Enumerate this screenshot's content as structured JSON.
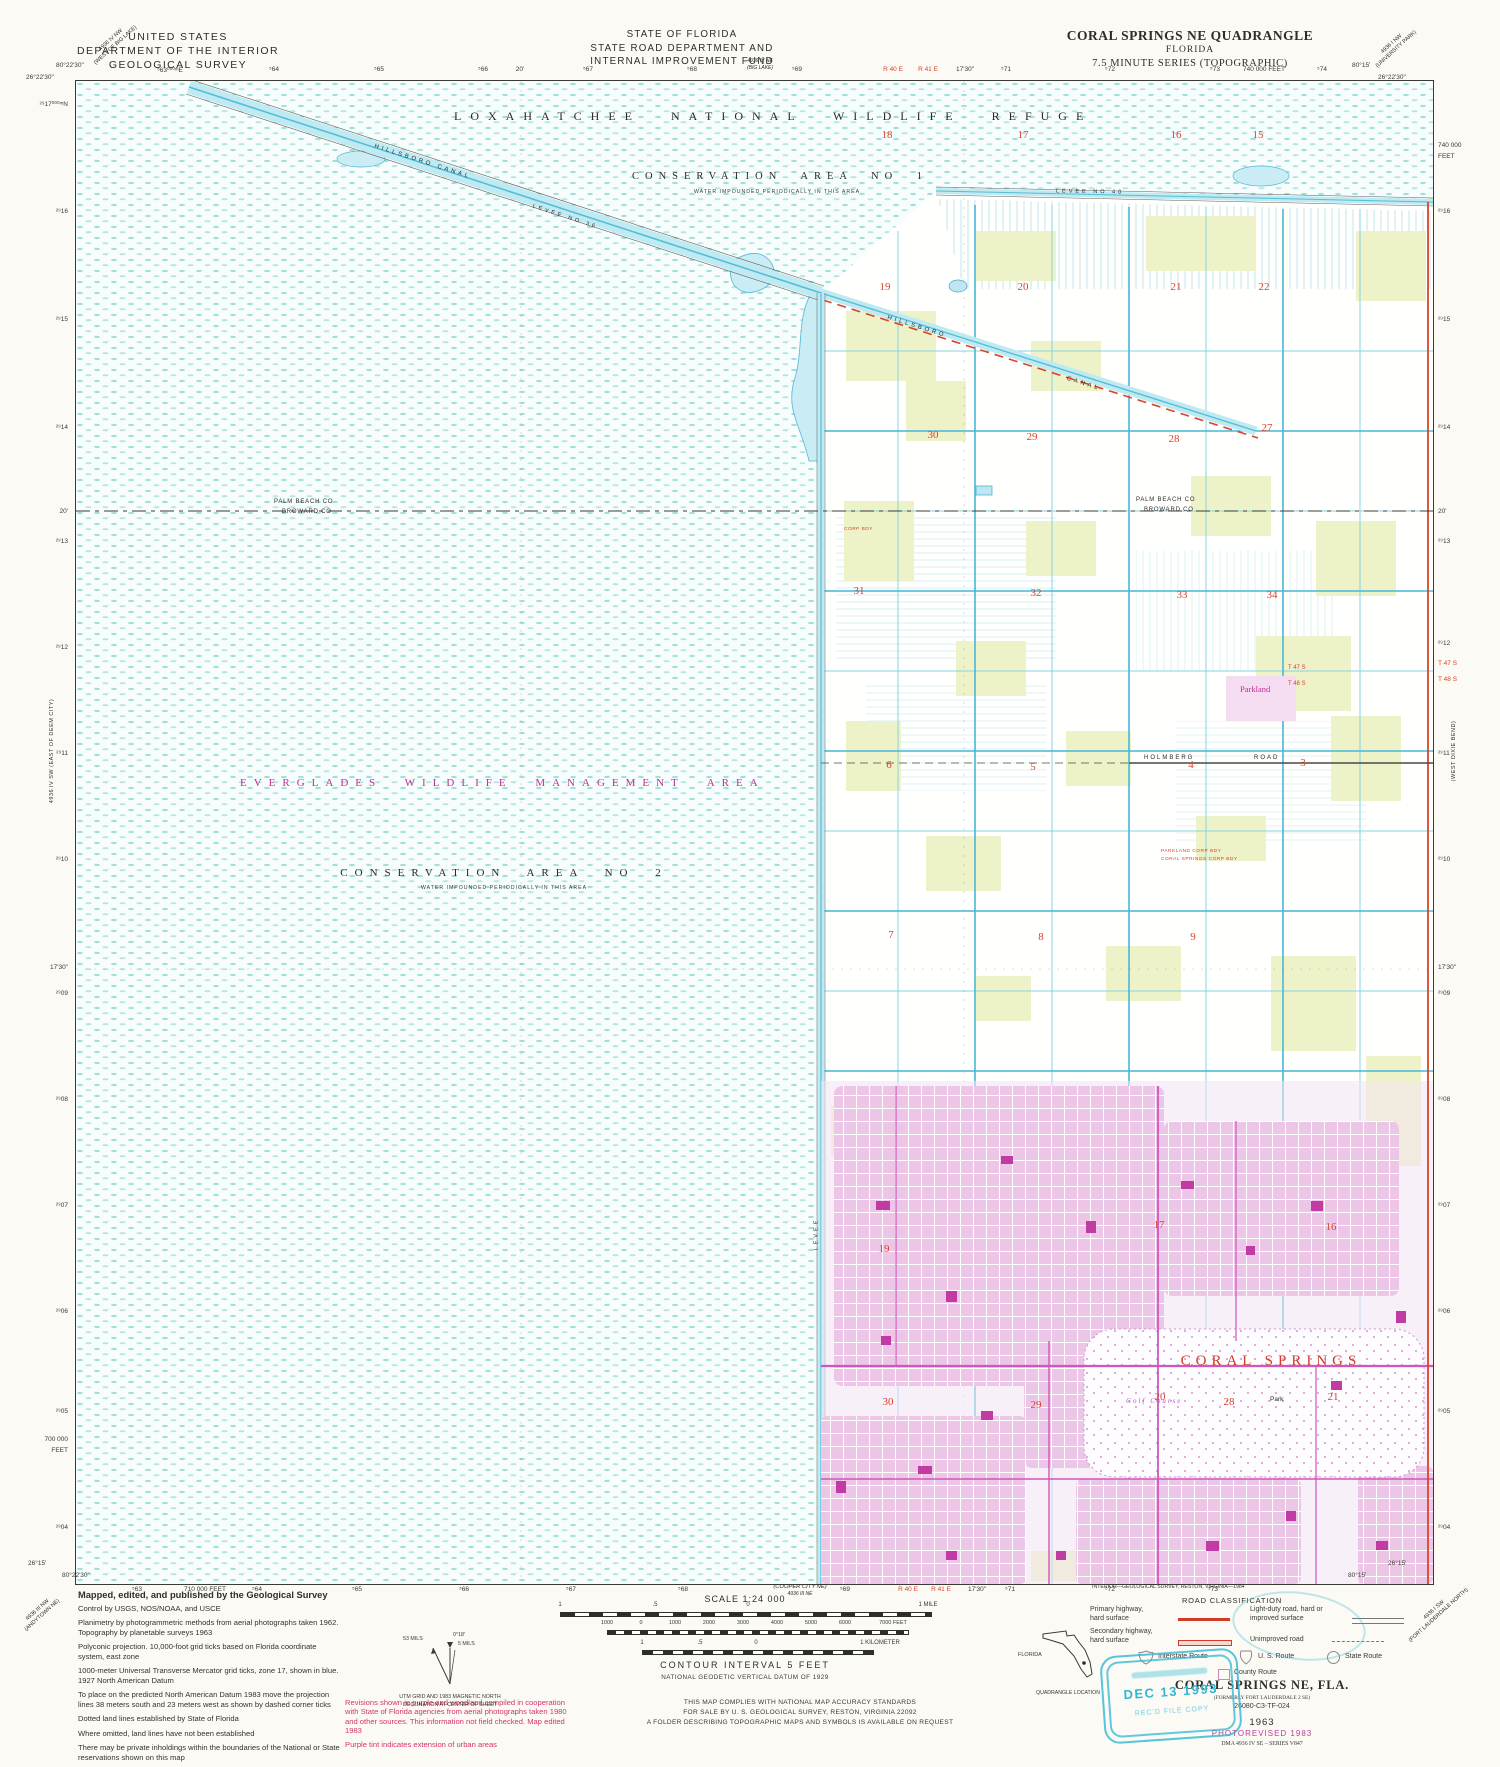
{
  "colors": {
    "map_red": "#d8432c",
    "magenta": "#c23a9b",
    "print_red": "#d5336e",
    "canal_cyan": "#54bdd8",
    "stamp_cyan": "#2fb7d4"
  },
  "header": {
    "agency_line1": "UNITED STATES",
    "agency_line2": "DEPARTMENT OF THE INTERIOR",
    "agency_line3": "GEOLOGICAL SURVEY",
    "state_line1": "STATE OF FLORIDA",
    "state_line2": "STATE ROAD DEPARTMENT AND",
    "state_line3": "INTERNAL IMPROVEMENT FUND",
    "state_sub1": "4936 IV NE",
    "state_sub2": "(BIG LAKE)",
    "quad_line1": "CORAL SPRINGS NE QUADRANGLE",
    "quad_line2": "FLORIDA",
    "quad_line3": "7.5 MINUTE SERIES (TOPOGRAPHIC)",
    "corner_tl1": "4936 IV NW",
    "corner_tl2": "(WEST OF BIG LAKE)",
    "corner_tr1": "4936 I NW",
    "corner_tr2": "(UNIVERSITY PARK)"
  },
  "edges": {
    "top_left_lon": "80°22'30\"",
    "top_left_lat": "26°22'30\"",
    "top_right_lon": "80°15'",
    "top_right_lat": "26°22'30\"",
    "bottom_left_lat": "26°15'",
    "bottom_left_lon": "80°22'30\"",
    "bottom_right_lon": "80°15'",
    "bottom_right_lat": "26°15'",
    "side_left": "4936 IV SW (EAST OF DEEM CITY)",
    "side_right": "(WEST DIXIE BEND)",
    "corner_bl1": "4936 III NW",
    "corner_bl2": "(ANDYTOWN NE)",
    "corner_br1": "4936 I SW",
    "corner_br2": "(FORT LAUDERDALE NORTH)",
    "cooper1": "(COOPER CITY NE)",
    "cooper2": "4936 III NE",
    "top_ticks": [
      {
        "t": "⁵63⁰⁰⁰ᵐE",
        "x": 170
      },
      {
        "t": "⁵64",
        "x": 274
      },
      {
        "t": "⁵65",
        "x": 379
      },
      {
        "t": "⁵66",
        "x": 483
      },
      {
        "t": "20'",
        "x": 520
      },
      {
        "t": "⁵67",
        "x": 588
      },
      {
        "t": "⁵68",
        "x": 692
      },
      {
        "t": "⁵69",
        "x": 797
      },
      {
        "t": "R 40 E",
        "x": 893,
        "red": true
      },
      {
        "t": "R 41 E",
        "x": 928,
        "red": true
      },
      {
        "t": "17'30\"",
        "x": 965
      },
      {
        "t": "⁵71",
        "x": 1006
      },
      {
        "t": "⁵72",
        "x": 1110
      },
      {
        "t": "⁵73",
        "x": 1215
      },
      {
        "t": "740 000 FEET",
        "x": 1264
      },
      {
        "t": "⁵74",
        "x": 1322
      }
    ],
    "left_ticks": [
      {
        "t": "²⁹17⁰⁰⁰ᵐN",
        "y": 104
      },
      {
        "t": "²⁹16",
        "y": 212
      },
      {
        "t": "²⁹15",
        "y": 320
      },
      {
        "t": "²⁹14",
        "y": 428
      },
      {
        "t": "20'",
        "y": 512
      },
      {
        "t": "²⁹13",
        "y": 542
      },
      {
        "t": "²⁹12",
        "y": 648
      },
      {
        "t": "²⁹11",
        "y": 754
      },
      {
        "t": "²⁹10",
        "y": 860
      },
      {
        "t": "17'30\"",
        "y": 968
      },
      {
        "t": "²⁹09",
        "y": 994
      },
      {
        "t": "²⁹08",
        "y": 1100
      },
      {
        "t": "²⁹07",
        "y": 1206
      },
      {
        "t": "²⁹06",
        "y": 1312
      },
      {
        "t": "²⁹05",
        "y": 1412
      },
      {
        "t": "700 000",
        "y": 1440
      },
      {
        "t": "FEET",
        "y": 1451
      },
      {
        "t": "²⁹04",
        "y": 1528
      }
    ],
    "right_ticks": [
      {
        "t": "740 000",
        "y": 146
      },
      {
        "t": "FEET",
        "y": 157
      },
      {
        "t": "²⁹16",
        "y": 212
      },
      {
        "t": "²⁹15",
        "y": 320
      },
      {
        "t": "²⁹14",
        "y": 428
      },
      {
        "t": "20'",
        "y": 512
      },
      {
        "t": "²⁹13",
        "y": 542
      },
      {
        "t": "²⁹12",
        "y": 644
      },
      {
        "t": "T 47 S",
        "y": 664,
        "red": true
      },
      {
        "t": "T 48 S",
        "y": 680,
        "red": true
      },
      {
        "t": "²⁹11",
        "y": 754
      },
      {
        "t": "²⁹10",
        "y": 860
      },
      {
        "t": "17'30\"",
        "y": 968
      },
      {
        "t": "²⁹09",
        "y": 994
      },
      {
        "t": "²⁹08",
        "y": 1100
      },
      {
        "t": "²⁹07",
        "y": 1206
      },
      {
        "t": "²⁹06",
        "y": 1312
      },
      {
        "t": "²⁹05",
        "y": 1412
      },
      {
        "t": "²⁹04",
        "y": 1528
      }
    ],
    "bottom_ticks": [
      {
        "t": "⁵63",
        "x": 137
      },
      {
        "t": "710 000 FEET",
        "x": 205
      },
      {
        "t": "⁵64",
        "x": 257
      },
      {
        "t": "⁵65",
        "x": 357
      },
      {
        "t": "⁵66",
        "x": 464
      },
      {
        "t": "⁵67",
        "x": 571
      },
      {
        "t": "⁵68",
        "x": 683
      },
      {
        "t": "⁵69",
        "x": 845
      },
      {
        "t": "R 40 E",
        "x": 908,
        "red": true
      },
      {
        "t": "R 41 E",
        "x": 941,
        "red": true
      },
      {
        "t": "17'30\"",
        "x": 977
      },
      {
        "t": "⁵71",
        "x": 1010
      },
      {
        "t": "⁵72",
        "x": 1110
      },
      {
        "t": "⁵73",
        "x": 1213
      }
    ]
  },
  "map_labels": {
    "refuge": "LOXAHATCHEE NATIONAL WILDLIFE REFUGE",
    "conservation1": "CONSERVATION AREA NO 1",
    "conservation1_sub": "WATER IMPOUNDED PERIODICALLY IN THIS AREA",
    "everglades": "EVERGLADES WILDLIFE MANAGEMENT AREA",
    "conservation2": "CONSERVATION AREA NO 2",
    "conservation2_sub": "WATER IMPOUNDED PERIODICALLY IN THIS AREA",
    "hillsboro1": "HILLSBORO CANAL",
    "levee36": "LEVEE NO 36",
    "levee40": "LEVEE NO 40",
    "levee_w": "LEVEE",
    "hillsboro2": "HILLSBORO",
    "canal2": "CANAL",
    "county_n1": "PALM BEACH CO",
    "county_n2": "BROWARD CO",
    "t47": "T 47 S",
    "t48": "T 48 S",
    "parkland": "Parkland",
    "holmberg": "HOLMBERG",
    "road": "ROAD",
    "coral_springs": "CORAL SPRINGS",
    "golf": "Golf Course",
    "park": "Park",
    "corp1": "PARKLAND CORP BDY",
    "corp2": "CORAL SPRINGS CORP BDY",
    "corp3": "CORP BDY"
  },
  "section_numbers": [
    {
      "n": "18",
      "x": 811,
      "y": 48
    },
    {
      "n": "17",
      "x": 947,
      "y": 48
    },
    {
      "n": "16",
      "x": 1100,
      "y": 48
    },
    {
      "n": "15",
      "x": 1182,
      "y": 48
    },
    {
      "n": "19",
      "x": 809,
      "y": 200
    },
    {
      "n": "20",
      "x": 947,
      "y": 200
    },
    {
      "n": "21",
      "x": 1100,
      "y": 200
    },
    {
      "n": "22",
      "x": 1188,
      "y": 200
    },
    {
      "n": "30",
      "x": 857,
      "y": 348
    },
    {
      "n": "29",
      "x": 956,
      "y": 350
    },
    {
      "n": "28",
      "x": 1098,
      "y": 352
    },
    {
      "n": "27",
      "x": 1191,
      "y": 341
    },
    {
      "n": "31",
      "x": 783,
      "y": 504
    },
    {
      "n": "32",
      "x": 960,
      "y": 506
    },
    {
      "n": "33",
      "x": 1106,
      "y": 508
    },
    {
      "n": "34",
      "x": 1196,
      "y": 508
    },
    {
      "n": "6",
      "x": 813,
      "y": 678
    },
    {
      "n": "5",
      "x": 957,
      "y": 680
    },
    {
      "n": "4",
      "x": 1115,
      "y": 678
    },
    {
      "n": "3",
      "x": 1227,
      "y": 676
    },
    {
      "n": "7",
      "x": 815,
      "y": 848
    },
    {
      "n": "8",
      "x": 965,
      "y": 850
    },
    {
      "n": "9",
      "x": 1117,
      "y": 850
    },
    {
      "n": "17",
      "x": 1083,
      "y": 1138
    },
    {
      "n": "16",
      "x": 1255,
      "y": 1140
    },
    {
      "n": "19",
      "x": 808,
      "y": 1162
    },
    {
      "n": "20",
      "x": 1084,
      "y": 1310
    },
    {
      "n": "21",
      "x": 1257,
      "y": 1310
    },
    {
      "n": "30",
      "x": 812,
      "y": 1315
    },
    {
      "n": "29",
      "x": 960,
      "y": 1318
    },
    {
      "n": "28",
      "x": 1153,
      "y": 1315
    }
  ],
  "footer": {
    "credit_head": "Mapped, edited, and published by the Geological Survey",
    "credits": [
      "Control by USGS, NOS/NOAA, and USCE",
      "Planimetry by photogrammetric methods from aerial photographs taken 1962.   Topography by planetable surveys 1963",
      "Polyconic projection.   10,000-foot grid ticks based on Florida coordinate system, east zone",
      "1000-meter Universal Transverse Mercator grid ticks, zone 17, shown in blue.   1927 North American Datum",
      "To place on the predicted North American Datum 1983 move the projection lines 38 meters south and 23 meters west as shown by dashed corner ticks",
      "Dotted land lines established by State of Florida",
      "Where omitted, land lines have not been established",
      "There may be private inholdings within the boundaries of the National or State reservations shown on this map"
    ],
    "revisions": [
      "Revisions shown in purple and woodland compiled in cooperation with State of Florida agencies from aerial photographs taken 1980 and other sources.   This information not field checked.   Map edited 1983",
      "Purple tint indicates extension of urban areas"
    ],
    "declination": {
      "mils53": "53 MILS",
      "deg": "0°18'",
      "mils5": "5 MILS",
      "cap1": "UTM GRID AND 1983 MAGNETIC NORTH",
      "cap2": "DECLINATION AT CENTER OF SHEET"
    },
    "scale": {
      "title": "SCALE 1:24 000",
      "mile": [
        "1",
        ".5",
        "0",
        "1 MILE"
      ],
      "feet": [
        "1000",
        "0",
        "1000",
        "2000",
        "3000",
        "4000",
        "5000",
        "6000",
        "7000 FEET"
      ],
      "km": [
        "1",
        ".5",
        "0",
        "1 KILOMETER"
      ],
      "contour": "CONTOUR INTERVAL 5 FEET",
      "datum": "NATIONAL GEODETIC VERTICAL DATUM OF 1929"
    },
    "compliance": [
      "THIS MAP COMPLIES WITH NATIONAL MAP ACCURACY STANDARDS",
      "FOR SALE BY U. S. GEOLOGICAL SURVEY, RESTON, VIRGINIA 22092",
      "A FOLDER DESCRIBING TOPOGRAPHIC MAPS AND SYMBOLS IS AVAILABLE ON REQUEST"
    ],
    "printer": "INTERIOR—GEOLOGICAL SURVEY, RESTON, VIRGINIA—1984",
    "road_class": {
      "title": "ROAD CLASSIFICATION",
      "primary1": "Primary highway,",
      "primary2": "hard surface",
      "secondary1": "Secondary highway,",
      "secondary2": "hard surface",
      "light1": "Light-duty road, hard or",
      "light2": "improved surface",
      "unimproved": "Unimproved road",
      "interstate": "Interstate Route",
      "us": "U. S. Route",
      "state": "State Route",
      "county": "County Route"
    },
    "title_block": {
      "name": "CORAL SPRINGS NE, FLA.",
      "formerly": "(FORMERLY FORT LAUDERDALE 2 SE)",
      "code": "26080-C3-TF-024",
      "year": "1963",
      "photorev": "PHOTOREVISED 1983",
      "dma": "DMA 4936 IV SE – SERIES V847"
    },
    "florida_label": "FLORIDA",
    "quad_loc": "QUADRANGLE LOCATION",
    "stamp": {
      "date": "DEC 13 1993",
      "line2": "REC'D FILE COPY"
    }
  }
}
